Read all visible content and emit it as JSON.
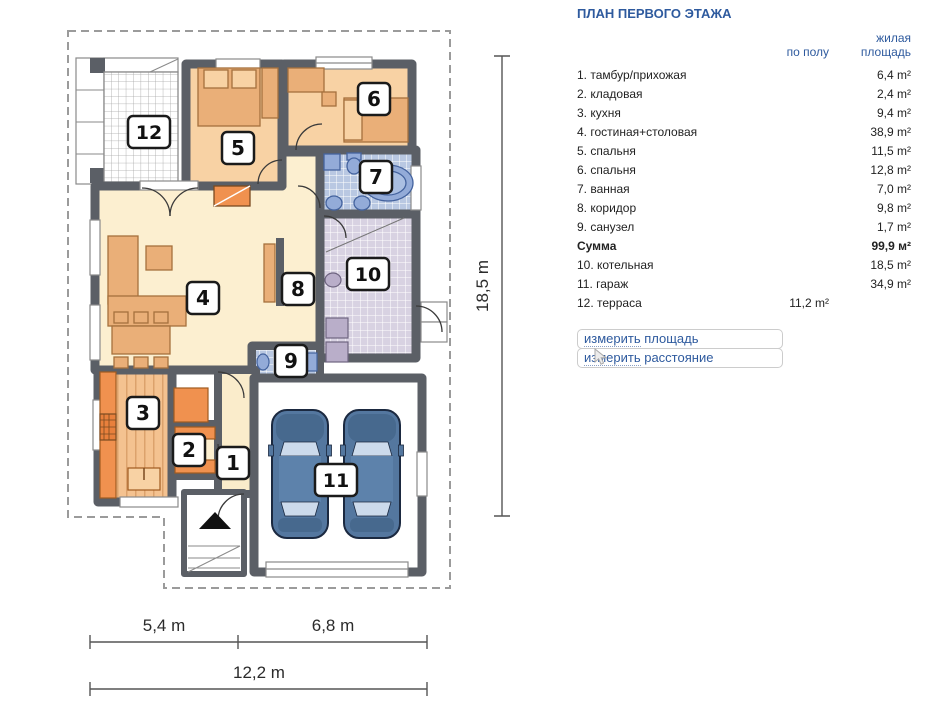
{
  "panel": {
    "title": "ПЛАН ПЕРВОГО ЭТАЖА",
    "col_floor": "по полу",
    "col_living": "жилая площадь",
    "rows": [
      {
        "label": "1. тамбур/прихожая",
        "floor": "",
        "living": "6,4 m²",
        "bold": false
      },
      {
        "label": "2. кладовая",
        "floor": "",
        "living": "2,4 m²",
        "bold": false
      },
      {
        "label": "3. кухня",
        "floor": "",
        "living": "9,4 m²",
        "bold": false
      },
      {
        "label": "4. гостиная+столовая",
        "floor": "",
        "living": "38,9 m²",
        "bold": false
      },
      {
        "label": "5. спальня",
        "floor": "",
        "living": "11,5 m²",
        "bold": false
      },
      {
        "label": "6. спальня",
        "floor": "",
        "living": "12,8 m²",
        "bold": false
      },
      {
        "label": "7. ванная",
        "floor": "",
        "living": "7,0 m²",
        "bold": false
      },
      {
        "label": "8. коридор",
        "floor": "",
        "living": "9,8 m²",
        "bold": false
      },
      {
        "label": "9. санузел",
        "floor": "",
        "living": "1,7 m²",
        "bold": false
      },
      {
        "label": "Сумма",
        "floor": "",
        "living": "99,9 м²",
        "bold": true
      },
      {
        "label": "10. котельная",
        "floor": "",
        "living": "18,5 m²",
        "bold": false
      },
      {
        "label": "11. гараж",
        "floor": "",
        "living": "34,9 m²",
        "bold": false
      },
      {
        "label": "12. терраса",
        "floor": "11,2 m²",
        "living": "",
        "bold": false
      }
    ],
    "links": [
      {
        "word": "измерить",
        "rest": " площадь"
      },
      {
        "word": "измерить",
        "rest": " расстояние"
      }
    ]
  },
  "plan": {
    "rooms": [
      {
        "num": "1",
        "name": "тамбур/прихожая"
      },
      {
        "num": "2",
        "name": "кладовая"
      },
      {
        "num": "3",
        "name": "кухня"
      },
      {
        "num": "4",
        "name": "гостиная+столовая"
      },
      {
        "num": "5",
        "name": "спальня"
      },
      {
        "num": "6",
        "name": "спальня"
      },
      {
        "num": "7",
        "name": "ванная"
      },
      {
        "num": "8",
        "name": "коридор"
      },
      {
        "num": "9",
        "name": "санузел"
      },
      {
        "num": "10",
        "name": "котельная"
      },
      {
        "num": "11",
        "name": "гараж"
      },
      {
        "num": "12",
        "name": "терраса"
      }
    ],
    "dimensions": {
      "height": "18,5 m",
      "width_left": "5,4 m",
      "width_right": "6,8 m",
      "width_total": "12,2 m"
    }
  },
  "colors": {
    "title_blue": "#2e5a9e",
    "link_blue": "#2e5a9e",
    "wall_gray": "#5b5f66",
    "floor_cream": "#fcefd0",
    "floor_bedroom": "#f8d2a4",
    "tile_bath": "#b9c8e2",
    "tile_boiler": "#d8d2e2",
    "furniture_orange": "#eaaf78",
    "accent_orange": "#f0914f",
    "car_blue": "#54779f"
  }
}
